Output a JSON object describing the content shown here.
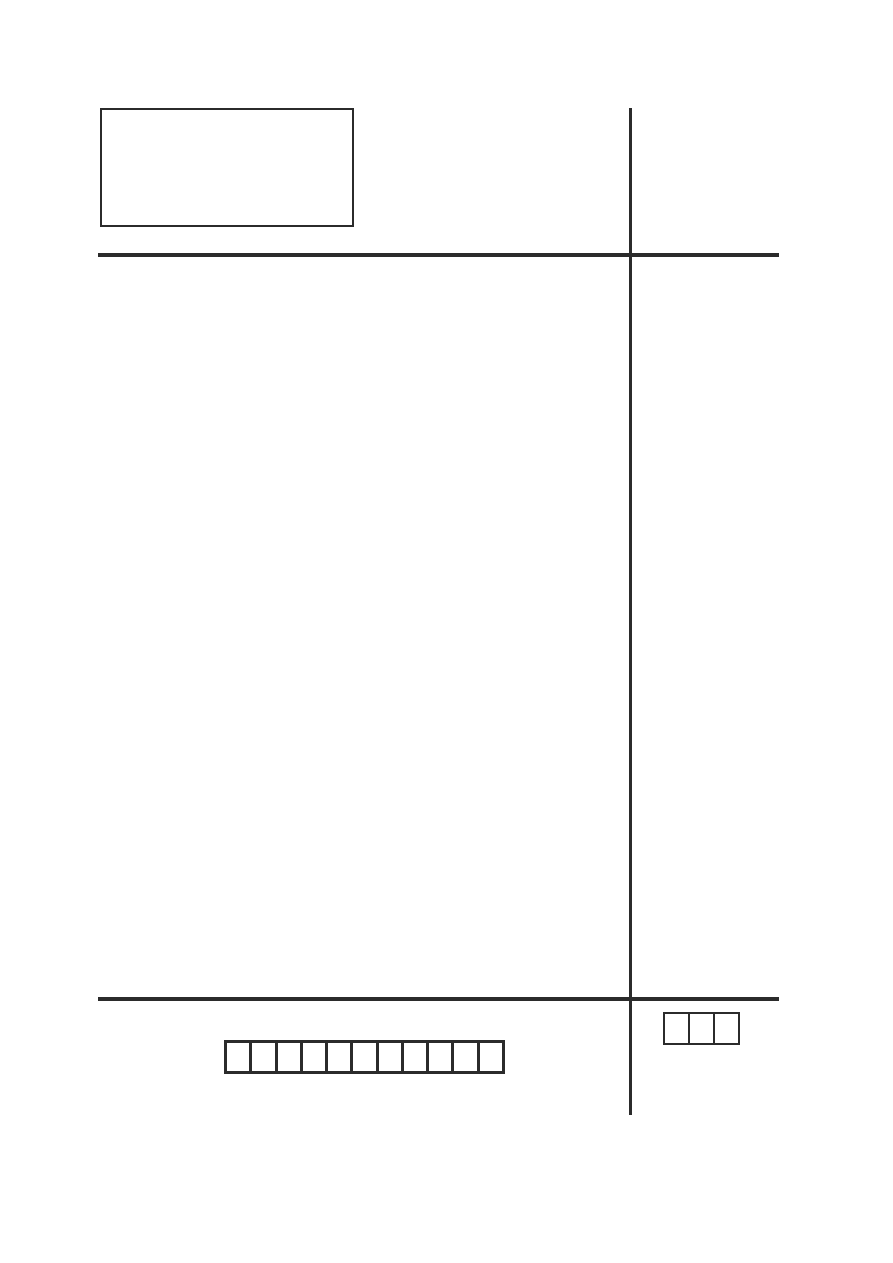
{
  "page": {
    "background_color": "#ffffff",
    "line_color": "#2b2b2b",
    "kind": "blank scanned form page"
  },
  "header": {
    "info_box": {
      "content": ""
    }
  },
  "rules": {
    "vertical_divider": 1,
    "horizontal_rules": 2
  },
  "footer": {
    "id_boxes": {
      "count": 11,
      "values": [
        "",
        "",
        "",
        "",
        "",
        "",
        "",
        "",
        "",
        "",
        ""
      ]
    },
    "score_boxes": {
      "count": 3,
      "values": [
        "",
        "",
        ""
      ]
    }
  }
}
